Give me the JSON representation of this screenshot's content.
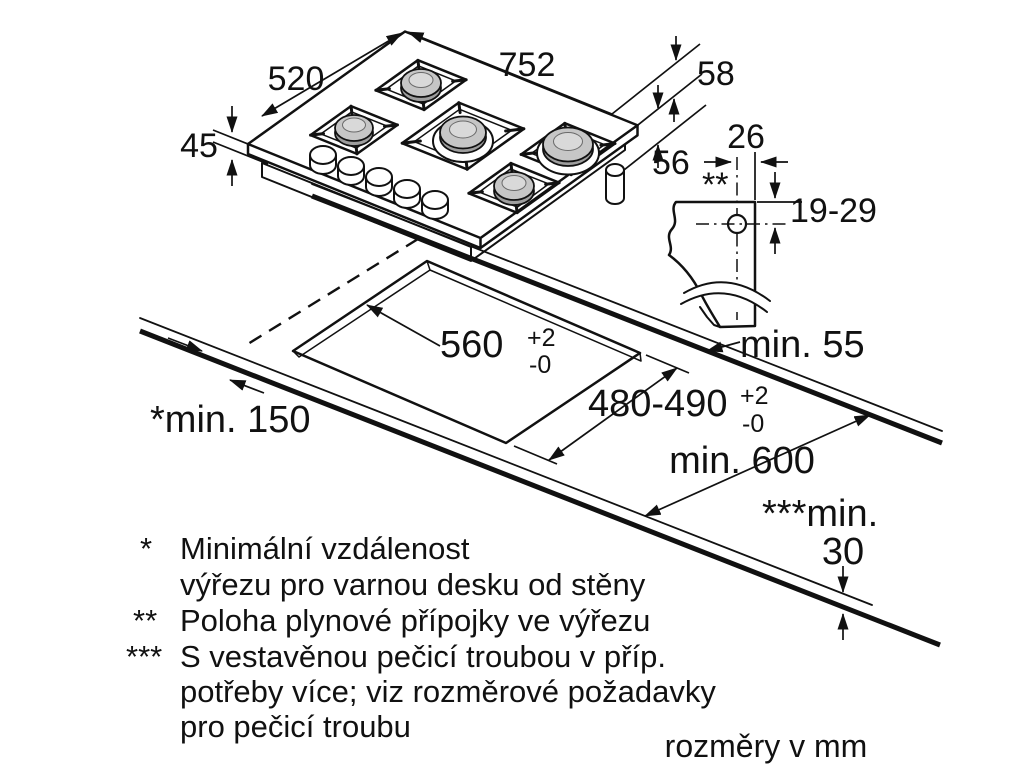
{
  "page": {
    "background": "#ffffff",
    "units_note": "rozměry v mm"
  },
  "hob": {
    "width": "752",
    "depth": "520",
    "height": "45",
    "gas_offset_top": "58",
    "gas_offset_side": "56"
  },
  "gas_detail": {
    "offset_from_edge": "26",
    "position_ref": "**",
    "depth_range": "19-29"
  },
  "cutout": {
    "width": "560",
    "width_tol_plus": "+2",
    "width_tol_minus": "-0",
    "depth": "480-490",
    "depth_tol_plus": "+2",
    "depth_tol_minus": "-0",
    "back_clearance": "min. 55",
    "side_clearance": "*min. 150",
    "counter_depth": "min. 600",
    "oven_clearance_prefix": "***min.",
    "oven_clearance_value": "30"
  },
  "legend": {
    "items": [
      {
        "marker": "*",
        "lines": [
          "Minimální vzdálenost",
          "výřezu pro varnou desku od stěny"
        ]
      },
      {
        "marker": "**",
        "lines": [
          "Poloha plynové přípojky ve výřezu"
        ]
      },
      {
        "marker": "***",
        "lines": [
          "S vestavěnou pečicí troubou v příp.",
          "potřeby více; viz rozměrové požadavky",
          "pro pečicí troubu"
        ]
      }
    ]
  }
}
